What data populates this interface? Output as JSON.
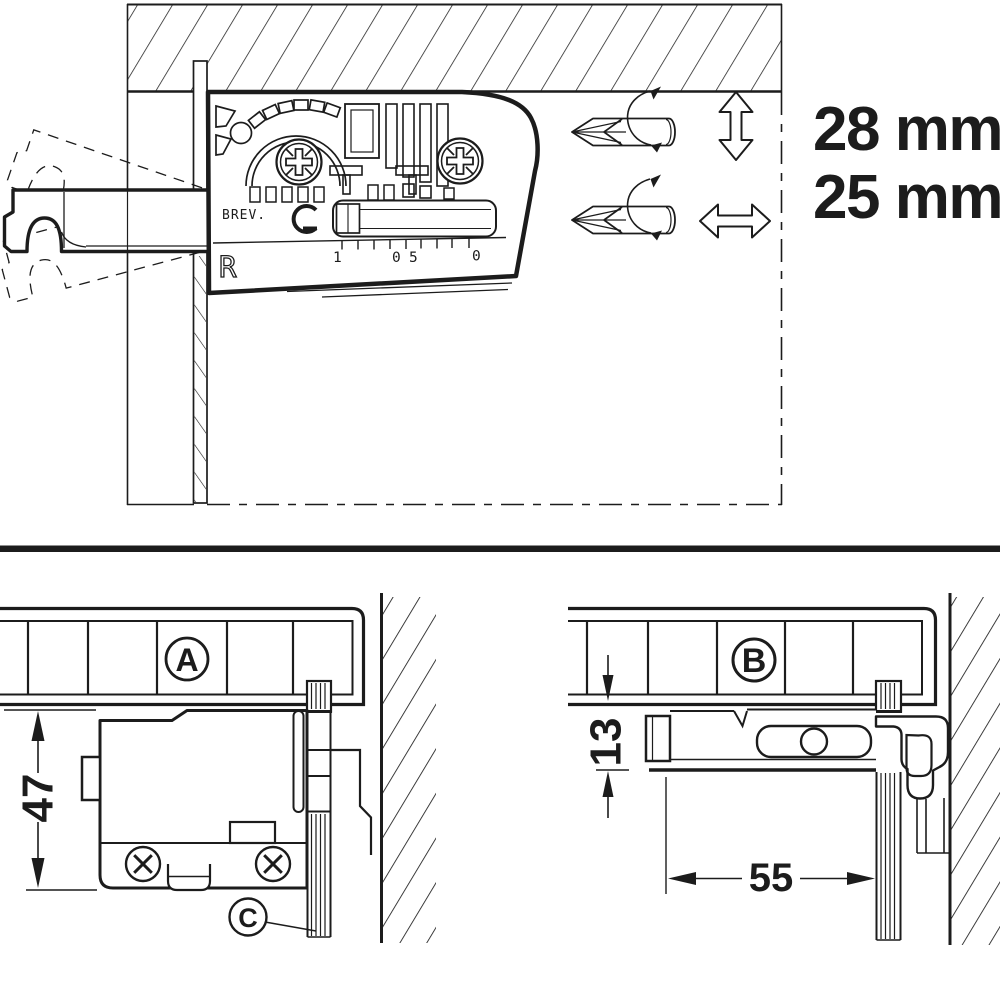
{
  "drawing": {
    "labels": {
      "screw_length_top": "28 mm",
      "screw_length_bottom": "25 mm"
    },
    "bracket": {
      "patent_abbrev": "BREV.",
      "orientation_mark": "R",
      "scale_marks": [
        "1",
        "0",
        "5",
        "0"
      ]
    },
    "details": {
      "a": {
        "label": "A",
        "dim_height": "47",
        "part_label": "C"
      },
      "b": {
        "label": "B",
        "dim_gap": "13",
        "dim_depth": "55"
      }
    },
    "icons": {
      "screwdriver": "pozidriv-screwdriver-icon",
      "vertical_adjust": "double-arrow-vertical-icon",
      "horizontal_adjust": "double-arrow-horizontal-icon",
      "rotation": "rotation-arrow-icon",
      "screw_head": "screw-cross-icon"
    },
    "colors": {
      "ink": "#1c1c1c",
      "background": "#ffffff"
    }
  }
}
